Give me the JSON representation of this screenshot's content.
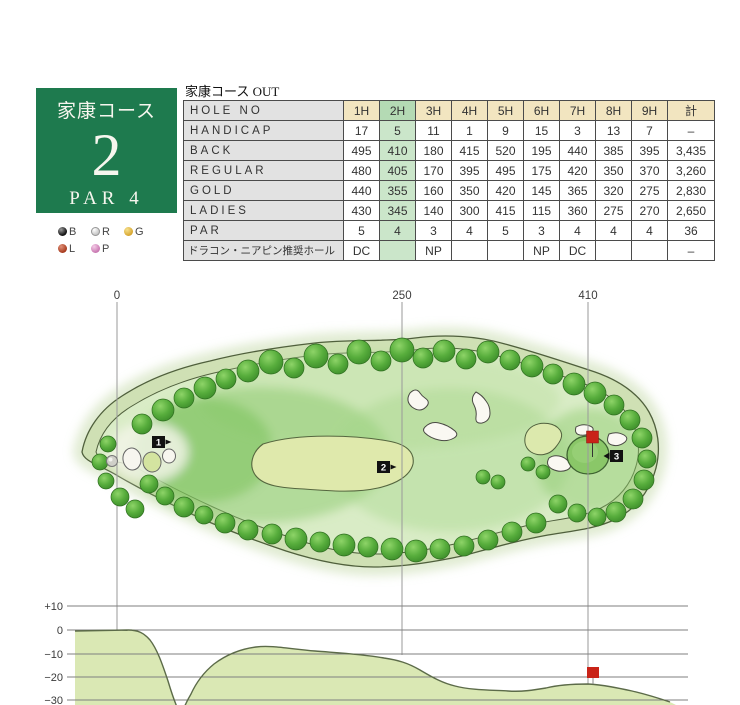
{
  "page_title": "家康コース OUT",
  "course_card": {
    "course_name": "家康コース",
    "hole_number": "2",
    "par_label": "PAR 4"
  },
  "tee_legend": {
    "items": [
      {
        "code": "B",
        "color": "#151515"
      },
      {
        "code": "R",
        "color": "#c9c9c9"
      },
      {
        "code": "G",
        "color": "#d5a22a"
      },
      {
        "code": "L",
        "color": "#a33416"
      },
      {
        "code": "P",
        "color": "#c571ad"
      }
    ]
  },
  "scorecard": {
    "header": {
      "label": "HOLE NO",
      "cols": [
        "1H",
        "2H",
        "3H",
        "4H",
        "5H",
        "6H",
        "7H",
        "8H",
        "9H",
        "計"
      ]
    },
    "rows": [
      {
        "label": "HANDICAP",
        "values": [
          "17",
          "5",
          "11",
          "1",
          "9",
          "15",
          "3",
          "13",
          "7",
          "–"
        ]
      },
      {
        "label": "BACK",
        "values": [
          "495",
          "410",
          "180",
          "415",
          "520",
          "195",
          "440",
          "385",
          "395",
          "3,435"
        ]
      },
      {
        "label": "REGULAR",
        "values": [
          "480",
          "405",
          "170",
          "395",
          "495",
          "175",
          "420",
          "350",
          "370",
          "3,260"
        ]
      },
      {
        "label": "GOLD",
        "values": [
          "440",
          "355",
          "160",
          "350",
          "420",
          "145",
          "365",
          "320",
          "275",
          "2,830"
        ]
      },
      {
        "label": "LADIES",
        "values": [
          "430",
          "345",
          "140",
          "300",
          "415",
          "115",
          "360",
          "275",
          "270",
          "2,650"
        ]
      },
      {
        "label": "PAR",
        "values": [
          "5",
          "4",
          "3",
          "4",
          "5",
          "3",
          "4",
          "4",
          "4",
          "36"
        ]
      },
      {
        "label": "ドラコン・ニアピン推奨ホール",
        "values": [
          "DC",
          "",
          "NP",
          "",
          "",
          "NP",
          "DC",
          "",
          "",
          "–"
        ]
      }
    ],
    "highlighted_column": "2H"
  },
  "course_map": {
    "distance_markers": [
      "0",
      "250",
      "410"
    ],
    "tee_markers": [
      "1",
      "2",
      "3"
    ]
  },
  "elevation_profile": {
    "axis_labels": [
      "+10",
      "0",
      "−10",
      "−20",
      "−30"
    ]
  },
  "colors": {
    "card_green": "#1e7a4e",
    "header_tan": "#f2e5c0",
    "highlight_green": "#cbe6ca",
    "flag_red": "#c92318"
  }
}
